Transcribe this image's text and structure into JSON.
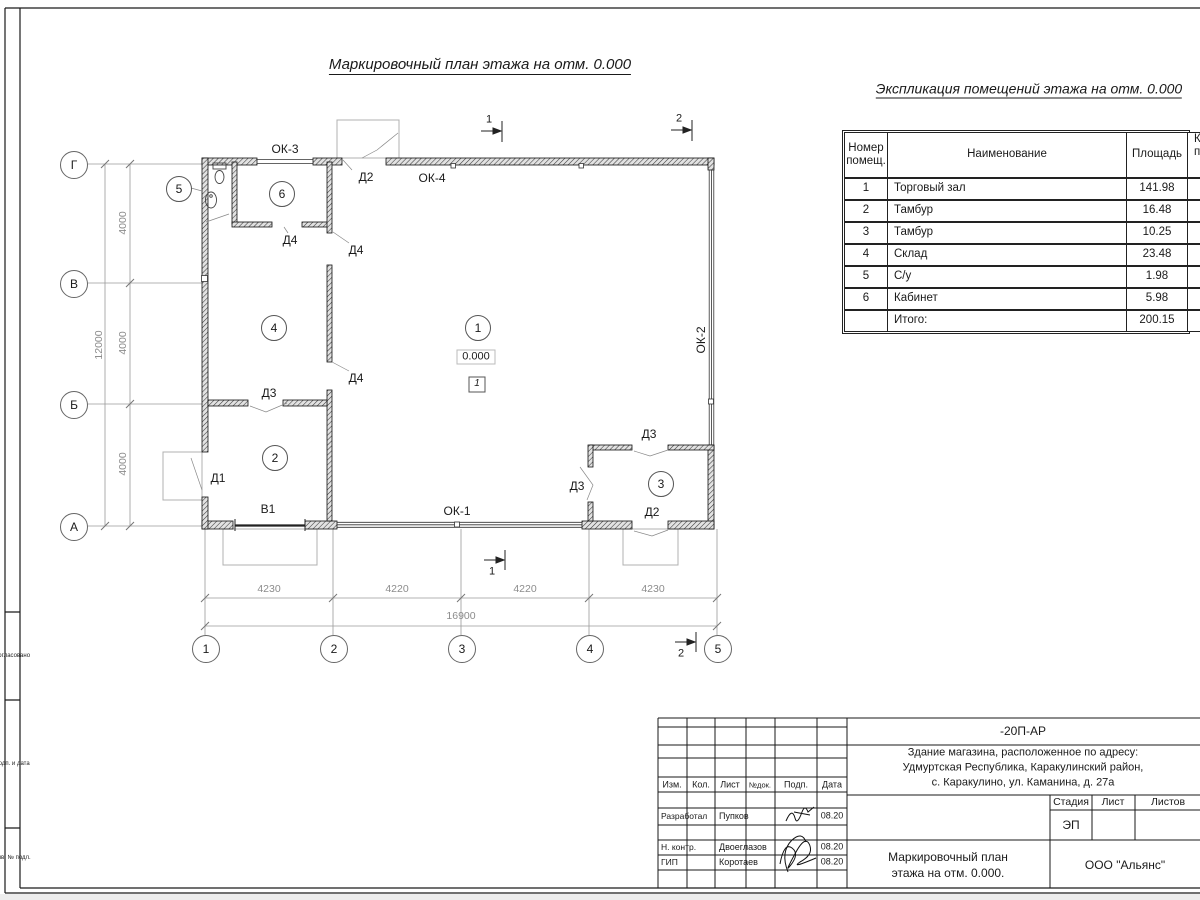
{
  "sheet": {
    "plan_title": "Маркировочный план этажа на отм. 0.000",
    "explication_title": "Экспликация помещений этажа на отм. 0.000"
  },
  "explication": {
    "headers": {
      "num_line1": "Номер",
      "num_line2": "помещ.",
      "name": "Наименование",
      "area": "Площадь",
      "extra_line1": "Ка",
      "extra_line2": "по"
    },
    "rows": [
      {
        "num": "1",
        "name": "Торговый зал",
        "area": "141.98"
      },
      {
        "num": "2",
        "name": "Тамбур",
        "area": "16.48"
      },
      {
        "num": "3",
        "name": "Тамбур",
        "area": "10.25"
      },
      {
        "num": "4",
        "name": "Склад",
        "area": "23.48"
      },
      {
        "num": "5",
        "name": "С/у",
        "area": "1.98"
      },
      {
        "num": "6",
        "name": "Кабинет",
        "area": "5.98"
      }
    ],
    "total": {
      "label": "Итого:",
      "area": "200.15"
    }
  },
  "plan": {
    "axis_left": [
      "Г",
      "В",
      "Б",
      "А"
    ],
    "axis_bottom": [
      "1",
      "2",
      "3",
      "4",
      "5"
    ],
    "dims_left": [
      "4000",
      "4000",
      "4000"
    ],
    "dim_left_total": "12000",
    "dims_bottom": [
      "4230",
      "4220",
      "4220",
      "4230"
    ],
    "dim_bottom_total": "16900",
    "room_circles": [
      "5",
      "6",
      "4",
      "1",
      "2",
      "3"
    ],
    "labels": {
      "ok3": "ОК-3",
      "d2_top": "Д2",
      "ok4": "ОК-4",
      "d4_a": "Д4",
      "d4_b": "Д4",
      "d4_c": "Д4",
      "d3_a": "Д3",
      "d1": "Д1",
      "v1": "В1",
      "ok1": "ОК-1",
      "d3_b": "Д3",
      "d3_c": "Д3",
      "d2_b": "Д2",
      "ok2": "ОК-2"
    },
    "level_mark": "0.000",
    "layout_tag": "1",
    "sections": {
      "top1": "1",
      "top2": "2",
      "bottom1": "1",
      "bottom2": "2"
    }
  },
  "title_block": {
    "code": "-20П-АР",
    "address_line1": "Здание магазина, расположенное по адресу:",
    "address_line2": "Удмуртская Республика, Каракулинский район,",
    "address_line3": "с. Каракулино, ул. Каманина, д. 27а",
    "cols": {
      "izm": "Изм.",
      "kol": "Кол.",
      "list": "Лист",
      "ndok": "№док.",
      "podp": "Подп.",
      "data": "Дата"
    },
    "rows": [
      {
        "role": "Разработал",
        "name": "Пупков",
        "date": "08.20"
      },
      {
        "role": "Н. контр.",
        "name": "Двоеглазов",
        "date": "08.20"
      },
      {
        "role": "ГИП",
        "name": "Коротаев",
        "date": "08.20"
      }
    ],
    "stage_label": "Стадия",
    "sheet_label": "Лист",
    "sheets_label": "Листов",
    "stage_value": "ЭП",
    "doc_title_line1": "Маркировочный план",
    "doc_title_line2": "этажа на отм. 0.000.",
    "company": "ООО \"Альянс\""
  },
  "stamp": {
    "box1": "Согласовано",
    "box2": "Подп. и дата",
    "box3": "Инв. № подл."
  }
}
